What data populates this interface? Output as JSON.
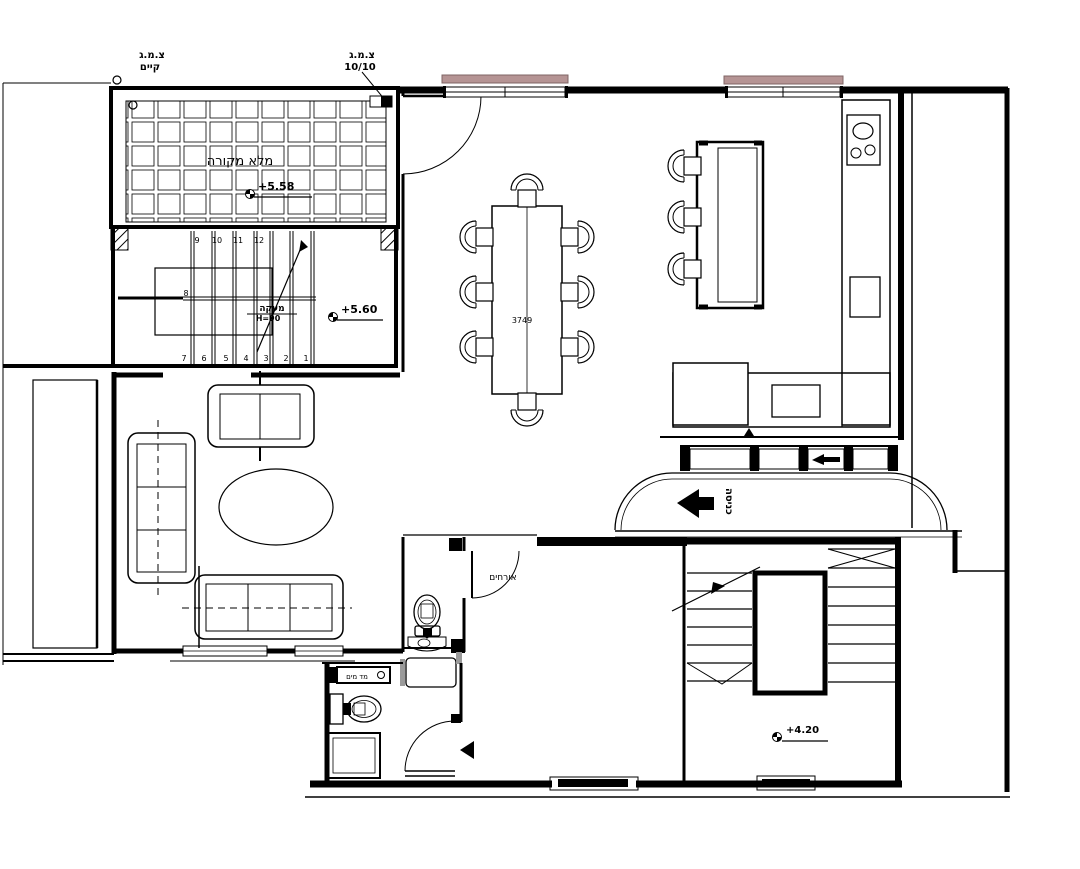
{
  "colors": {
    "line": "#000000",
    "lintel_fill": "#b59494",
    "lintel_border": "#7f6565",
    "shade_gray": "#9a9a9a"
  },
  "labels": {
    "pergola": "מלא מקורה",
    "elev_pergola": "+5.58",
    "elev_stair_top": "+5.60",
    "elev_entry": "+4.20",
    "railing_l1": "מעקה",
    "railing_l2": "H=90",
    "drain_existing_l1": "צ.מ.ג",
    "drain_existing_l2": "קיים",
    "drain_new_l1": "צ.מ.ג",
    "drain_new_l2": "10/10",
    "table_dim": "3749",
    "guests": "אורחים",
    "entrance": "כניסה",
    "meter_box": "מד מים",
    "stairs_upper": [
      "9",
      "10",
      "11",
      "12"
    ],
    "stair_mid": "8",
    "stairs_lower": [
      "7",
      "6",
      "5",
      "4",
      "3",
      "2",
      "1"
    ]
  }
}
